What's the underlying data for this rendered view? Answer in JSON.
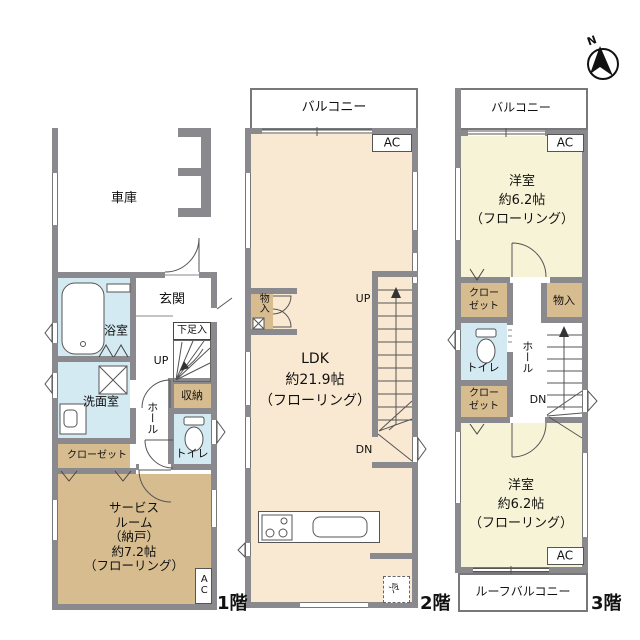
{
  "compass": {
    "north": "N"
  },
  "floors": {
    "f1": {
      "label": "1階",
      "garage": "車庫",
      "bath": "浴室",
      "entrance": "玄関",
      "shoe_cabinet": "下足入",
      "up": "UP",
      "storage": "収納",
      "toilet": "トイレ",
      "washroom": "洗面室",
      "hall": "ホール",
      "closet": "クローゼット",
      "service_room": [
        "サービス",
        "ルーム",
        "（納戸）",
        "約7.2帖",
        "（フローリング）"
      ],
      "ac": "AC"
    },
    "f2": {
      "label": "2階",
      "balcony": "バルコニー",
      "ac": "AC",
      "ldk": [
        "LDK",
        "約21.9帖",
        "（フローリング）"
      ],
      "up": "UP",
      "dn": "DN",
      "storage": "物入",
      "fridge": "冷"
    },
    "f3": {
      "label": "3階",
      "balcony": "バルコニー",
      "ac_top": "AC",
      "bedroom_top": [
        "洋室",
        "約6.2帖",
        "（フローリング）"
      ],
      "closet_top": [
        "クロー",
        "ゼット"
      ],
      "storage": "物入",
      "toilet": "トイレ",
      "hall": "ホール",
      "dn": "DN",
      "closet_bottom": [
        "クロー",
        "ゼット"
      ],
      "bedroom_bottom": [
        "洋室",
        "約6.2帖",
        "（フローリング）"
      ],
      "ac_bottom": "AC",
      "roof_balcony": "ルーフバルコニー"
    }
  },
  "colors": {
    "wall": "#8a8a8e",
    "ldk_cream": "#fae9d2",
    "wood_tan": "#d7bc90",
    "water_blue": "#d3eaf2",
    "bedroom_yellow": "#f7f3d6"
  }
}
